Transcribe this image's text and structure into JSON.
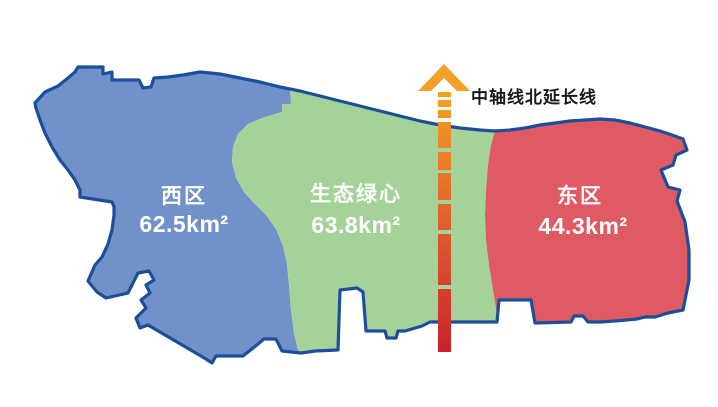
{
  "map": {
    "outline_color": "#1d4e9c",
    "background": "#ffffff",
    "region_label_color": "#ffffff",
    "axis_label_color": "#1a1a1a"
  },
  "regions": [
    {
      "id": "west",
      "name": "西区",
      "area": "62.5km²",
      "fill": "#7191c9"
    },
    {
      "id": "green-heart",
      "name": "生态绿心",
      "area": "63.8km²",
      "fill": "#a5d299"
    },
    {
      "id": "east",
      "name": "东区",
      "area": "44.3km²",
      "fill": "#e05a64"
    }
  ],
  "axis": {
    "label": "中轴线北延长线",
    "arrow_color": "#f2a028",
    "gradient_top": "#f6a21f",
    "gradient_mid": "#e06030",
    "gradient_bottom": "#c9232a"
  }
}
